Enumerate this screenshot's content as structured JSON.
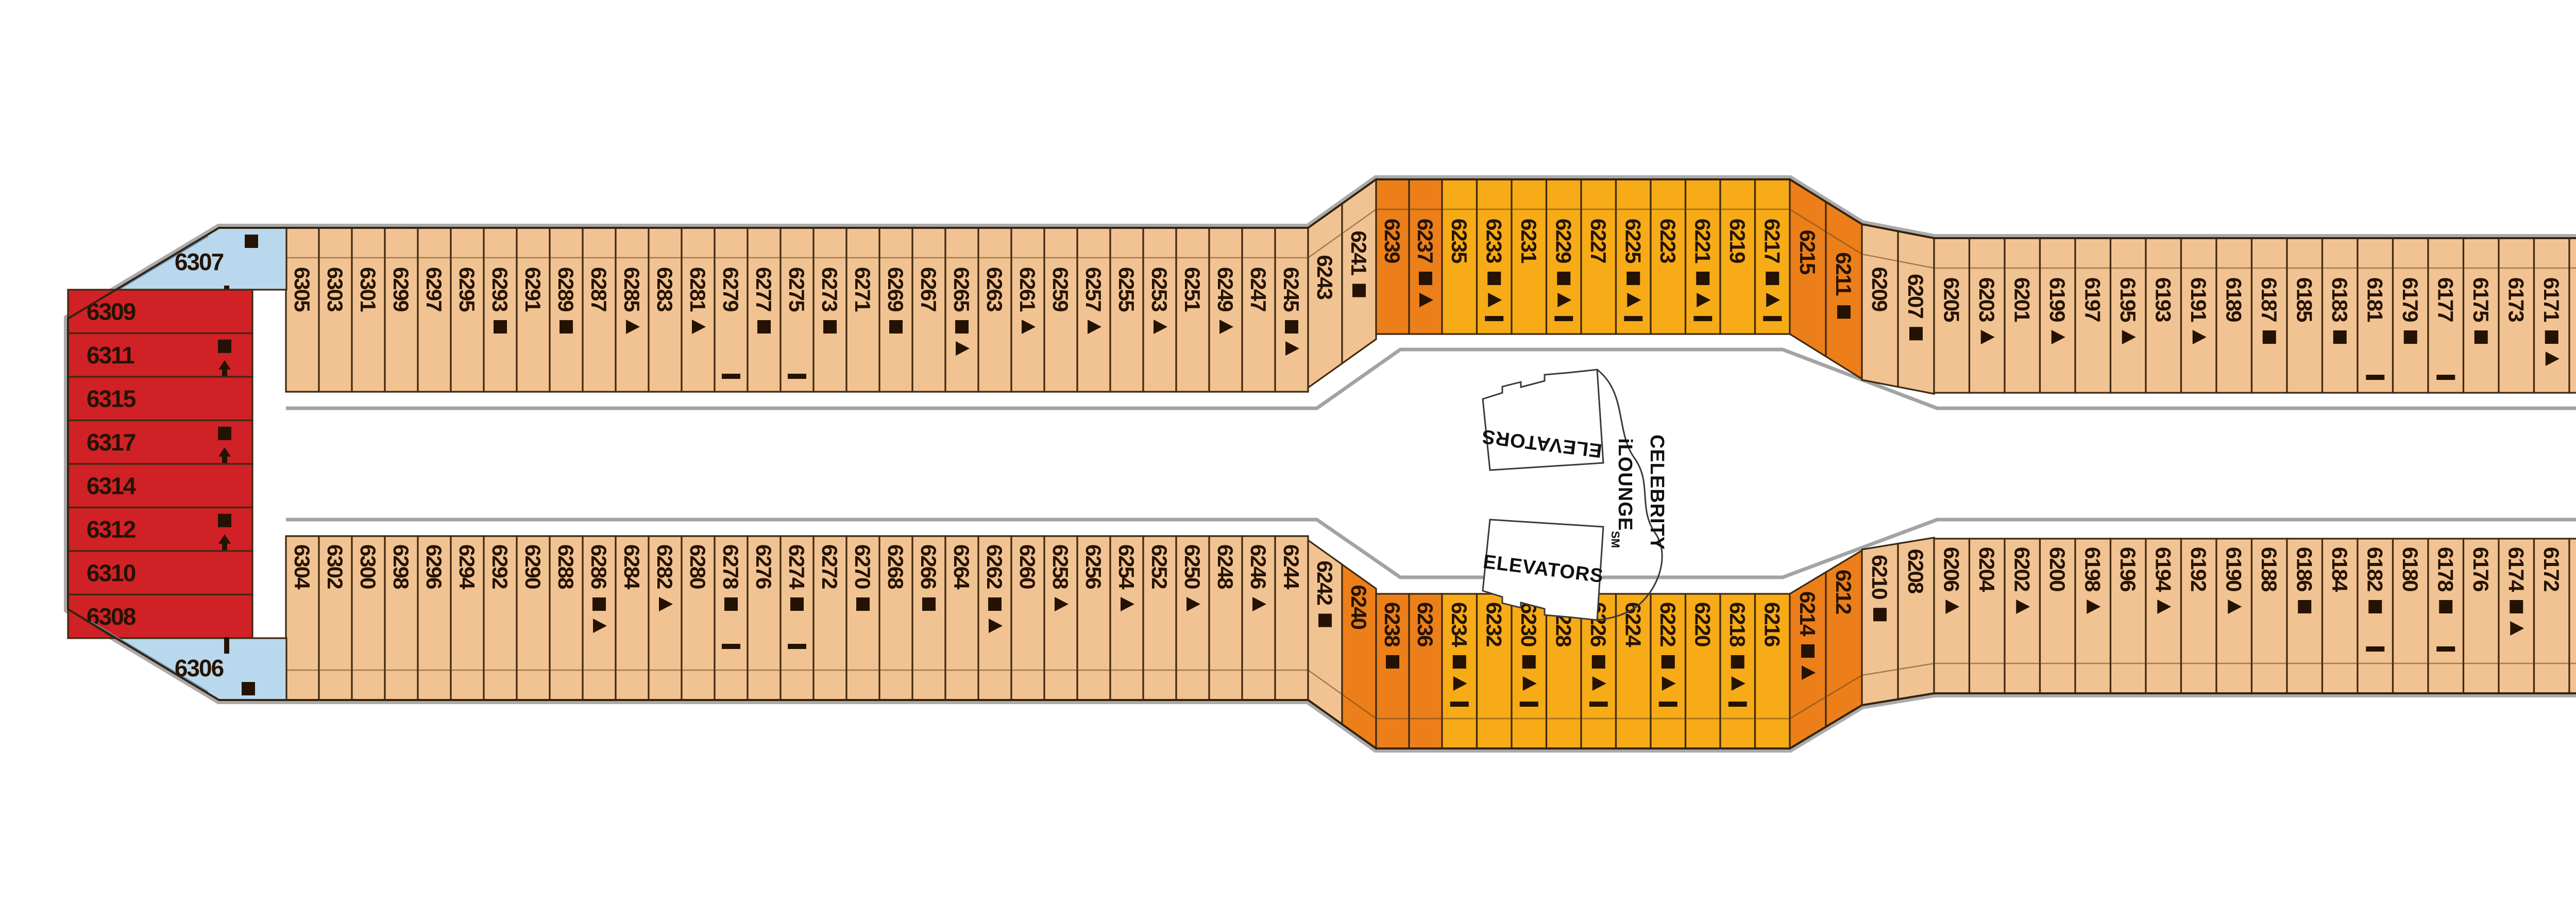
{
  "labels": {
    "elevators_mid_top": "ELEVATORS",
    "elevators_mid_bottom": "ELEVATORS",
    "lounge_line1": "CELEBRITY",
    "lounge_line2": "iLOUNGE",
    "lounge_sm": "SM",
    "elevators_fwd": "ELEVATORS"
  },
  "colors": {
    "peach": "#f2c392",
    "amber": "#f6ab17",
    "orange": "#ec7f1a",
    "yellow": "#f4e50f",
    "red": "#d02127",
    "blue": "#b9d8ed",
    "ink": "#241303"
  },
  "cabins": {
    "aft": [
      {
        "n": "6307",
        "c": "blue",
        "i": "sq,vdash"
      },
      {
        "n": "6309",
        "c": "red",
        "i": ""
      },
      {
        "n": "6311",
        "c": "red",
        "i": "sq,up"
      },
      {
        "n": "6315",
        "c": "red",
        "i": ""
      },
      {
        "n": "6317",
        "c": "red",
        "i": "sq,up"
      },
      {
        "n": "6314",
        "c": "red",
        "i": ""
      },
      {
        "n": "6312",
        "c": "red",
        "i": "sq,up"
      },
      {
        "n": "6310",
        "c": "red",
        "i": ""
      },
      {
        "n": "6308",
        "c": "red",
        "i": ""
      },
      {
        "n": "6306",
        "c": "blue",
        "i": "vdash,sq"
      }
    ],
    "port": [
      {
        "n": "6305",
        "c": "peach",
        "i": ""
      },
      {
        "n": "6303",
        "c": "peach",
        "i": ""
      },
      {
        "n": "6301",
        "c": "peach",
        "i": ""
      },
      {
        "n": "6299",
        "c": "peach",
        "i": ""
      },
      {
        "n": "6297",
        "c": "peach",
        "i": ""
      },
      {
        "n": "6295",
        "c": "peach",
        "i": ""
      },
      {
        "n": "6293",
        "c": "peach",
        "i": "sq"
      },
      {
        "n": "6291",
        "c": "peach",
        "i": ""
      },
      {
        "n": "6289",
        "c": "peach",
        "i": "sq"
      },
      {
        "n": "6287",
        "c": "peach",
        "i": ""
      },
      {
        "n": "6285",
        "c": "peach",
        "i": "tri"
      },
      {
        "n": "6283",
        "c": "peach",
        "i": ""
      },
      {
        "n": "6281",
        "c": "peach",
        "i": "tri"
      },
      {
        "n": "6279",
        "c": "peach",
        "i": "dash"
      },
      {
        "n": "6277",
        "c": "peach",
        "i": "sq"
      },
      {
        "n": "6275",
        "c": "peach",
        "i": "dash"
      },
      {
        "n": "6273",
        "c": "peach",
        "i": "sq"
      },
      {
        "n": "6271",
        "c": "peach",
        "i": ""
      },
      {
        "n": "6269",
        "c": "peach",
        "i": "sq"
      },
      {
        "n": "6267",
        "c": "peach",
        "i": ""
      },
      {
        "n": "6265",
        "c": "peach",
        "i": "sq,tri"
      },
      {
        "n": "6263",
        "c": "peach",
        "i": ""
      },
      {
        "n": "6261",
        "c": "peach",
        "i": "tri"
      },
      {
        "n": "6259",
        "c": "peach",
        "i": ""
      },
      {
        "n": "6257",
        "c": "peach",
        "i": "tri"
      },
      {
        "n": "6255",
        "c": "peach",
        "i": ""
      },
      {
        "n": "6253",
        "c": "peach",
        "i": "tri"
      },
      {
        "n": "6251",
        "c": "peach",
        "i": ""
      },
      {
        "n": "6249",
        "c": "peach",
        "i": "tri"
      },
      {
        "n": "6247",
        "c": "peach",
        "i": ""
      },
      {
        "n": "6245",
        "c": "peach",
        "i": "sq,tri"
      },
      {
        "n": "6243",
        "c": "peach",
        "i": ""
      },
      {
        "n": "6241",
        "c": "peach",
        "i": "sq"
      },
      {
        "n": "6239",
        "c": "orange",
        "i": ""
      },
      {
        "n": "6237",
        "c": "orange",
        "i": "sq,tri"
      },
      {
        "n": "6235",
        "c": "amber",
        "i": ""
      },
      {
        "n": "6233",
        "c": "amber",
        "i": "sq,tri,dash"
      },
      {
        "n": "6231",
        "c": "amber",
        "i": ""
      },
      {
        "n": "6229",
        "c": "amber",
        "i": "sq,tri,dash"
      },
      {
        "n": "6227",
        "c": "amber",
        "i": ""
      },
      {
        "n": "6225",
        "c": "amber",
        "i": "sq,tri,dash"
      },
      {
        "n": "6223",
        "c": "amber",
        "i": ""
      },
      {
        "n": "6221",
        "c": "amber",
        "i": "sq,tri,dash"
      },
      {
        "n": "6219",
        "c": "amber",
        "i": ""
      },
      {
        "n": "6217",
        "c": "amber",
        "i": "sq,tri,dash"
      },
      {
        "n": "6215",
        "c": "orange",
        "i": ""
      },
      {
        "n": "6211",
        "c": "orange",
        "i": "sq"
      },
      {
        "n": "6209",
        "c": "peach",
        "i": ""
      },
      {
        "n": "6207",
        "c": "peach",
        "i": "sq"
      },
      {
        "n": "6205",
        "c": "peach",
        "i": ""
      },
      {
        "n": "6203",
        "c": "peach",
        "i": "tri"
      },
      {
        "n": "6201",
        "c": "peach",
        "i": ""
      },
      {
        "n": "6199",
        "c": "peach",
        "i": "tri"
      },
      {
        "n": "6197",
        "c": "peach",
        "i": ""
      },
      {
        "n": "6195",
        "c": "peach",
        "i": "tri"
      },
      {
        "n": "6193",
        "c": "peach",
        "i": ""
      },
      {
        "n": "6191",
        "c": "peach",
        "i": "tri"
      },
      {
        "n": "6189",
        "c": "peach",
        "i": ""
      },
      {
        "n": "6187",
        "c": "peach",
        "i": "sq"
      },
      {
        "n": "6185",
        "c": "peach",
        "i": ""
      },
      {
        "n": "6183",
        "c": "peach",
        "i": "sq"
      },
      {
        "n": "6181",
        "c": "peach",
        "i": "dash"
      },
      {
        "n": "6179",
        "c": "peach",
        "i": "sq"
      },
      {
        "n": "6177",
        "c": "peach",
        "i": "dash"
      },
      {
        "n": "6175",
        "c": "peach",
        "i": "sq"
      },
      {
        "n": "6173",
        "c": "peach",
        "i": ""
      },
      {
        "n": "6171",
        "c": "peach",
        "i": "sq,tri"
      },
      {
        "n": "6169",
        "c": "peach",
        "i": ""
      },
      {
        "n": "6167",
        "c": "peach",
        "i": "sq,tri"
      },
      {
        "n": "6165",
        "c": "peach",
        "i": ""
      },
      {
        "n": "6163",
        "c": "peach",
        "i": "sq,tri"
      },
      {
        "n": "6161",
        "c": "peach",
        "i": ""
      },
      {
        "n": "6159",
        "c": "peach",
        "i": "sq,tri"
      },
      {
        "n": "6157",
        "c": "peach",
        "i": ""
      },
      {
        "n": "6155",
        "c": "peach",
        "i": "sq,tri"
      },
      {
        "n": "6153",
        "c": "peach",
        "i": ""
      },
      {
        "n": "6151",
        "c": "peach",
        "i": "sq,tri"
      },
      {
        "n": "6149",
        "c": "peach",
        "i": ""
      },
      {
        "n": "6147",
        "c": "peach",
        "i": "sq,tri,dash"
      },
      {
        "n": "6145",
        "c": "peach",
        "i": ""
      },
      {
        "n": "6143",
        "c": "yellow",
        "i": "sq"
      },
      {
        "n": "6141",
        "c": "yellow",
        "i": "wc,sq"
      },
      {
        "n": "6139",
        "c": "yellow",
        "i": "wc,sq"
      },
      {
        "n": "6137",
        "c": "yellow",
        "i": "wc,sq"
      },
      {
        "n": "6135",
        "c": "yellow",
        "i": "wc,sq"
      },
      {
        "n": "6133",
        "c": "yellow",
        "i": ""
      },
      {
        "n": "6131",
        "c": "yellow",
        "i": "tri"
      },
      {
        "n": "6129",
        "c": "yellow",
        "i": ""
      },
      {
        "n": "6127",
        "c": "yellow",
        "i": "tri"
      },
      {
        "n": "6125",
        "c": "yellow",
        "i": ""
      },
      {
        "n": "6123",
        "c": "yellow",
        "i": "sq"
      },
      {
        "n": "6121",
        "c": "yellow",
        "i": ""
      },
      {
        "n": "6119",
        "c": "yellow",
        "i": "sq"
      },
      {
        "n": "6117",
        "c": "yellow",
        "i": ""
      },
      {
        "n": "6115",
        "c": "yellow",
        "i": "sq"
      },
      {
        "n": "6111",
        "c": "yellow",
        "i": ""
      },
      {
        "n": "6109",
        "c": "yellow",
        "i": "sq"
      },
      {
        "n": "6107",
        "c": "yellow",
        "i": ""
      },
      {
        "n": "6105",
        "c": "yellow",
        "i": "tri"
      },
      {
        "n": "6103",
        "c": "yellow",
        "i": ""
      },
      {
        "n": "6101",
        "c": "yellow",
        "i": "sq"
      }
    ],
    "starboard": [
      {
        "n": "6304",
        "c": "peach",
        "i": ""
      },
      {
        "n": "6302",
        "c": "peach",
        "i": ""
      },
      {
        "n": "6300",
        "c": "peach",
        "i": ""
      },
      {
        "n": "6298",
        "c": "peach",
        "i": ""
      },
      {
        "n": "6296",
        "c": "peach",
        "i": ""
      },
      {
        "n": "6294",
        "c": "peach",
        "i": ""
      },
      {
        "n": "6292",
        "c": "peach",
        "i": ""
      },
      {
        "n": "6290",
        "c": "peach",
        "i": ""
      },
      {
        "n": "6288",
        "c": "peach",
        "i": ""
      },
      {
        "n": "6286",
        "c": "peach",
        "i": "sq,tri"
      },
      {
        "n": "6284",
        "c": "peach",
        "i": ""
      },
      {
        "n": "6282",
        "c": "peach",
        "i": "tri"
      },
      {
        "n": "6280",
        "c": "peach",
        "i": ""
      },
      {
        "n": "6278",
        "c": "peach",
        "i": "sq,dash"
      },
      {
        "n": "6276",
        "c": "peach",
        "i": ""
      },
      {
        "n": "6274",
        "c": "peach",
        "i": "sq,dash"
      },
      {
        "n": "6272",
        "c": "peach",
        "i": ""
      },
      {
        "n": "6270",
        "c": "peach",
        "i": "sq"
      },
      {
        "n": "6268",
        "c": "peach",
        "i": ""
      },
      {
        "n": "6266",
        "c": "peach",
        "i": "sq"
      },
      {
        "n": "6264",
        "c": "peach",
        "i": ""
      },
      {
        "n": "6262",
        "c": "peach",
        "i": "sq,tri"
      },
      {
        "n": "6260",
        "c": "peach",
        "i": ""
      },
      {
        "n": "6258",
        "c": "peach",
        "i": "tri"
      },
      {
        "n": "6256",
        "c": "peach",
        "i": ""
      },
      {
        "n": "6254",
        "c": "peach",
        "i": "tri"
      },
      {
        "n": "6252",
        "c": "peach",
        "i": ""
      },
      {
        "n": "6250",
        "c": "peach",
        "i": "tri"
      },
      {
        "n": "6248",
        "c": "peach",
        "i": ""
      },
      {
        "n": "6246",
        "c": "peach",
        "i": "tri"
      },
      {
        "n": "6244",
        "c": "peach",
        "i": ""
      },
      {
        "n": "6242",
        "c": "peach",
        "i": "sq"
      },
      {
        "n": "6240",
        "c": "orange",
        "i": ""
      },
      {
        "n": "6238",
        "c": "orange",
        "i": "sq"
      },
      {
        "n": "6236",
        "c": "orange",
        "i": ""
      },
      {
        "n": "6234",
        "c": "amber",
        "i": "sq,tri,dash"
      },
      {
        "n": "6232",
        "c": "amber",
        "i": ""
      },
      {
        "n": "6230",
        "c": "amber",
        "i": "sq,tri,dash"
      },
      {
        "n": "6228",
        "c": "amber",
        "i": ""
      },
      {
        "n": "6226",
        "c": "amber",
        "i": "sq,tri,dash"
      },
      {
        "n": "6224",
        "c": "amber",
        "i": ""
      },
      {
        "n": "6222",
        "c": "amber",
        "i": "sq,tri,dash"
      },
      {
        "n": "6220",
        "c": "amber",
        "i": ""
      },
      {
        "n": "6218",
        "c": "amber",
        "i": "sq,tri,dash"
      },
      {
        "n": "6216",
        "c": "amber",
        "i": ""
      },
      {
        "n": "6214",
        "c": "orange",
        "i": "sq,tri"
      },
      {
        "n": "6212",
        "c": "orange",
        "i": ""
      },
      {
        "n": "6210",
        "c": "peach",
        "i": "sq"
      },
      {
        "n": "6208",
        "c": "peach",
        "i": ""
      },
      {
        "n": "6206",
        "c": "peach",
        "i": "tri"
      },
      {
        "n": "6204",
        "c": "peach",
        "i": ""
      },
      {
        "n": "6202",
        "c": "peach",
        "i": "tri"
      },
      {
        "n": "6200",
        "c": "peach",
        "i": ""
      },
      {
        "n": "6198",
        "c": "peach",
        "i": "tri"
      },
      {
        "n": "6196",
        "c": "peach",
        "i": ""
      },
      {
        "n": "6194",
        "c": "peach",
        "i": "tri"
      },
      {
        "n": "6192",
        "c": "peach",
        "i": ""
      },
      {
        "n": "6190",
        "c": "peach",
        "i": "tri"
      },
      {
        "n": "6188",
        "c": "peach",
        "i": ""
      },
      {
        "n": "6186",
        "c": "peach",
        "i": "sq"
      },
      {
        "n": "6184",
        "c": "peach",
        "i": ""
      },
      {
        "n": "6182",
        "c": "peach",
        "i": "sq,dash"
      },
      {
        "n": "6180",
        "c": "peach",
        "i": ""
      },
      {
        "n": "6178",
        "c": "peach",
        "i": "sq,dash"
      },
      {
        "n": "6176",
        "c": "peach",
        "i": ""
      },
      {
        "n": "6174",
        "c": "peach",
        "i": "sq,tri"
      },
      {
        "n": "6172",
        "c": "peach",
        "i": ""
      },
      {
        "n": "6170",
        "c": "peach",
        "i": "sq,tri"
      },
      {
        "n": "6168",
        "c": "peach",
        "i": ""
      },
      {
        "n": "6166",
        "c": "peach",
        "i": "sq,tri"
      },
      {
        "n": "6164",
        "c": "peach",
        "i": ""
      },
      {
        "n": "6162",
        "c": "peach",
        "i": "sq,tri"
      },
      {
        "n": "6160",
        "c": "peach",
        "i": ""
      },
      {
        "n": "6158",
        "c": "peach",
        "i": "sq,tri"
      },
      {
        "n": "6156",
        "c": "peach",
        "i": ""
      },
      {
        "n": "6154",
        "c": "peach",
        "i": "sq,tri"
      },
      {
        "n": "6152",
        "c": "peach",
        "i": ""
      },
      {
        "n": "6150",
        "c": "peach",
        "i": "sq,tri,dash"
      },
      {
        "n": "6148",
        "c": "peach",
        "i": ""
      },
      {
        "n": "6146",
        "c": "peach",
        "i": "tri"
      },
      {
        "n": "6144",
        "c": "yellow",
        "i": ""
      },
      {
        "n": "6142",
        "c": "yellow",
        "i": "tri"
      },
      {
        "n": "6140",
        "c": "yellow",
        "i": ""
      },
      {
        "n": "6138",
        "c": "yellow",
        "i": "tri"
      },
      {
        "n": "6136",
        "c": "yellow",
        "i": ""
      },
      {
        "n": "6134",
        "c": "yellow",
        "i": "tri"
      },
      {
        "n": "6132",
        "c": "yellow",
        "i": ""
      },
      {
        "n": "6130",
        "c": "yellow",
        "i": "tri"
      },
      {
        "n": "6128",
        "c": "yellow",
        "i": ""
      },
      {
        "n": "6126",
        "c": "yellow",
        "i": "sq"
      },
      {
        "n": "6124",
        "c": "yellow",
        "i": ""
      },
      {
        "n": "6122",
        "c": "yellow",
        "i": "sq"
      },
      {
        "n": "6120",
        "c": "yellow",
        "i": ""
      },
      {
        "n": "6118",
        "c": "yellow",
        "i": "sq"
      },
      {
        "n": "6116",
        "c": "yellow",
        "i": ""
      },
      {
        "n": "6114",
        "c": "yellow",
        "i": "sq"
      },
      {
        "n": "6112",
        "c": "yellow",
        "i": ""
      },
      {
        "n": "6110",
        "c": "yellow",
        "i": "sq"
      },
      {
        "n": "6108",
        "c": "yellow",
        "i": ""
      },
      {
        "n": "6106",
        "c": "yellow",
        "i": "tri"
      },
      {
        "n": "6104",
        "c": "yellow",
        "i": ""
      },
      {
        "n": "6102",
        "c": "yellow",
        "i": "sq"
      }
    ]
  }
}
